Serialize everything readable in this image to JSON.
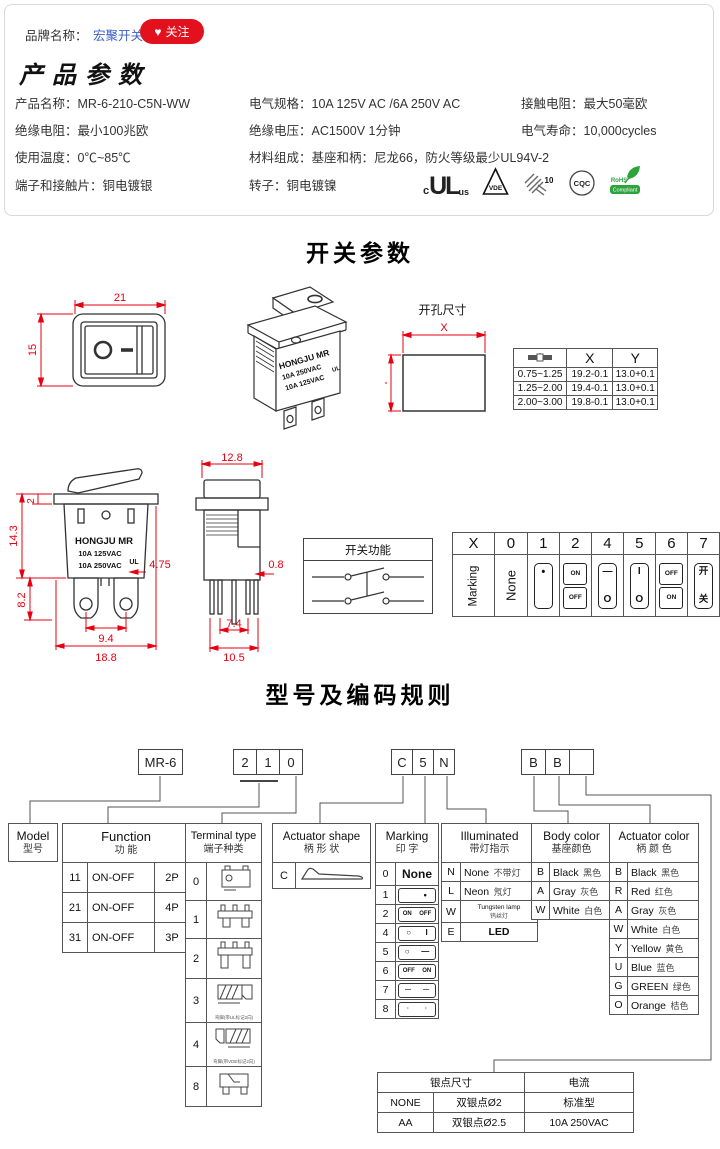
{
  "brand_bar": {
    "label": "品牌名称：",
    "brand": "宏聚开关",
    "heart_icon": "♥",
    "follow_label": "关注",
    "accent_red": "#e3101e",
    "link_blue": "#3a5fc4"
  },
  "product_params": {
    "title": "产品参数",
    "items": [
      {
        "k": "产品名称：",
        "v": "MR-6-210-C5N-WW"
      },
      {
        "k": "电气规格：",
        "v": "10A 125V AC /6A 250V AC"
      },
      {
        "k": "接触电阻：",
        "v": "最大50毫欧"
      },
      {
        "k": "绝缘电阻：",
        "v": "最小100兆欧"
      },
      {
        "k": "绝缘电压：",
        "v": "AC1500V 1分钟"
      },
      {
        "k": "电气寿命：",
        "v": "10,000cycles"
      },
      {
        "k": "使用温度：",
        "v": "0℃~85℃"
      },
      {
        "k": "材料组成：",
        "v": "基座和柄：尼龙66，防火等级最少UL94V-2"
      },
      {
        "k": "端子和接触片：",
        "v": "铜电镀银"
      },
      {
        "k": "转子：",
        "v": "铜电镀镍"
      }
    ],
    "certs": {
      "ul_c": "c",
      "ul": "UL",
      "ul_us": "us",
      "vde": "VDE",
      "enec_num": "10",
      "cqc": "CQC",
      "rohs_top": "RoHS",
      "rohs_bot": "Compliant"
    }
  },
  "switch_section": {
    "title": "开关参数",
    "front": {
      "dim_w": "21",
      "dim_h": "15",
      "dash": "—"
    },
    "iso": {
      "l1": "HONGJU MR",
      "l2": "10A 250VAC",
      "l3": "10A 125VAC",
      "ul": "UL"
    },
    "cutout": {
      "title": "开孔尺寸",
      "x": "X",
      "y": "Y",
      "col_x": "X",
      "col_y": "Y",
      "rows": [
        [
          "0.75~1.25",
          "19.2-0.1",
          "13.0+0.1"
        ],
        [
          "1.25~2.00",
          "19.4-0.1",
          "13.0+0.1"
        ],
        [
          "2.00~3.00",
          "19.8-0.1",
          "13.0+0.1"
        ]
      ]
    },
    "front2": {
      "l1": "HONGJU MR",
      "l2": "10A 125VAC",
      "l3": "10A 250VAC",
      "ul": "UL",
      "d_143": "14.3",
      "d_2": "2",
      "d_82": "8.2",
      "d_94": "9.4",
      "d_188": "18.8",
      "d_475": "4.75"
    },
    "side2": {
      "d_128": "12.8",
      "d_08": "0.8",
      "d_74": "7.4",
      "d_105": "10.5"
    },
    "func_box": {
      "title": "开关功能"
    },
    "xtable": {
      "headers": [
        "X",
        "0",
        "1",
        "2",
        "4",
        "5",
        "6",
        "7"
      ],
      "row_label": "Marking",
      "c0": "None",
      "c1_top": "•",
      "c1_bot": "",
      "c2_top": "ON",
      "c2_bot": "OFF",
      "c4_top": "—",
      "c4_bot": "O",
      "c5_top": "I",
      "c5_bot": "O",
      "c6_top": "OFF",
      "c6_bot": "ON",
      "c7_top": "开",
      "c7_bot": "关"
    }
  },
  "coding_section": {
    "title": "型号及编码规则",
    "code": {
      "model": "MR-6",
      "d1": "2",
      "d2": "1",
      "d3": "0",
      "a1": "C",
      "a2": "5",
      "a3": "N",
      "b1": "B",
      "b2": "B",
      "b3": ""
    },
    "model_box": {
      "en": "Model",
      "cn": "型号"
    },
    "function": {
      "en": "Function",
      "cn": "功  能",
      "rows": [
        {
          "code": "11",
          "label": "ON-OFF",
          "poles": "2P"
        },
        {
          "code": "21",
          "label": "ON-OFF",
          "poles": "4P"
        },
        {
          "code": "31",
          "label": "ON-OFF",
          "poles": "3P"
        }
      ]
    },
    "terminal": {
      "en": "Terminal type",
      "cn": "端子种类",
      "codes": [
        "0",
        "1",
        "2",
        "3",
        "4",
        "8"
      ],
      "cap3": "弯脚(带UL标记2向)",
      "cap4": "弯脚(带VDE标记2向)"
    },
    "actuator_shape": {
      "en": "Actuator shape",
      "cn": "柄 形 状",
      "code": "C"
    },
    "marking": {
      "en": "Marking",
      "cn": "印  字",
      "rows": [
        {
          "code": "0",
          "text": "None"
        },
        {
          "code": "1",
          "l": "",
          "r": "•"
        },
        {
          "code": "2",
          "l": "ON",
          "r": "OFF"
        },
        {
          "code": "4",
          "l": "○",
          "r": "I"
        },
        {
          "code": "5",
          "l": "○",
          "r": "—"
        },
        {
          "code": "6",
          "l": "OFF",
          "r": "ON"
        },
        {
          "code": "7",
          "l": "—",
          "r": "—"
        },
        {
          "code": "8",
          "l": "·",
          "r": "·"
        }
      ]
    },
    "illuminated": {
      "en": "Illuminated",
      "cn": "带灯指示",
      "rows": [
        {
          "code": "N",
          "en": "None",
          "cn": "不带灯"
        },
        {
          "code": "L",
          "en": "Neon",
          "cn": "氖灯"
        },
        {
          "code": "W",
          "en": "Tungsten lamp",
          "cn": "钨丝灯"
        },
        {
          "code": "E",
          "en": "LED",
          "cn": ""
        }
      ]
    },
    "body_color": {
      "en": "Body color",
      "cn": "基座颜色",
      "rows": [
        {
          "code": "B",
          "en": "Black",
          "cn": "黑色"
        },
        {
          "code": "A",
          "en": "Gray",
          "cn": "灰色"
        },
        {
          "code": "W",
          "en": "White",
          "cn": "白色"
        }
      ]
    },
    "actuator_color": {
      "en": "Actuator color",
      "cn": "柄 颜 色",
      "rows": [
        {
          "code": "B",
          "en": "Black",
          "cn": "黑色"
        },
        {
          "code": "R",
          "en": "Red",
          "cn": "红色"
        },
        {
          "code": "A",
          "en": "Gray",
          "cn": "灰色"
        },
        {
          "code": "W",
          "en": "White",
          "cn": "白色"
        },
        {
          "code": "Y",
          "en": "Yellow",
          "cn": "黄色"
        },
        {
          "code": "U",
          "en": "Blue",
          "cn": "蓝色"
        },
        {
          "code": "G",
          "en": "GREEN",
          "cn": "绿色"
        },
        {
          "code": "O",
          "en": "Orange",
          "cn": "桔色"
        }
      ]
    },
    "silver": {
      "h1": "银点尺寸",
      "h2": "电流",
      "rows": [
        [
          "NONE",
          "双银点Ø2",
          "标准型"
        ],
        [
          "AA",
          "双银点Ø2.5",
          "10A 250VAC"
        ]
      ]
    }
  }
}
